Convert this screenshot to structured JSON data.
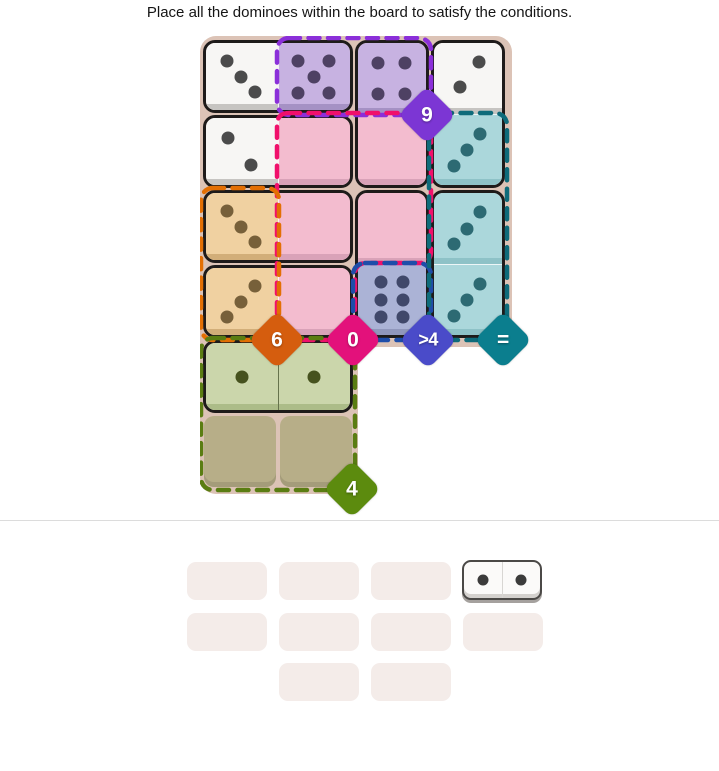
{
  "title": "Place all the dominoes within the board to satisfy the conditions.",
  "board": {
    "frame_color": "#dcc3b6",
    "faces": {
      "white": {
        "bg": "#f7f6f4",
        "pip": "#4b4b4b",
        "lip": "#c6c4c1"
      },
      "purple": {
        "bg": "#c7b2e1",
        "pip": "#4e4163",
        "lip": "#a591c4"
      },
      "pink": {
        "bg": "#f3bccf",
        "pip": "#8a5b72",
        "lip": "#d9a2b8"
      },
      "teal": {
        "bg": "#abd7db",
        "pip": "#2d6a73",
        "lip": "#8ec2c7"
      },
      "orange": {
        "bg": "#f0d1a1",
        "pip": "#77603a",
        "lip": "#d2ae79"
      },
      "blue": {
        "bg": "#abb3d6",
        "pip": "#40486a",
        "lip": "#9097bc"
      },
      "green": {
        "bg": "#cbd6ab",
        "pip": "#46521e",
        "lip": "#acbc88"
      },
      "empty": {
        "bg": "#b7ae88"
      }
    },
    "dominoes": [
      {
        "id": "domino-3-5",
        "cells": [
          [
            0,
            0
          ],
          [
            0,
            1
          ]
        ],
        "divider": "light",
        "halves": [
          {
            "face": "white",
            "pips": 3,
            "pattern": "three_down"
          },
          {
            "face": "purple",
            "pips": 5,
            "pattern": "five"
          }
        ]
      },
      {
        "id": "domino-4-0",
        "cells": [
          [
            0,
            2
          ],
          [
            1,
            2
          ]
        ],
        "divider": "light",
        "halves": [
          {
            "face": "purple",
            "pips": 4,
            "pattern": "four"
          },
          {
            "face": "pink",
            "pips": 0,
            "pattern": "blank"
          }
        ]
      },
      {
        "id": "domino-2-3",
        "cells": [
          [
            0,
            3
          ],
          [
            1,
            3
          ]
        ],
        "divider": "light",
        "halves": [
          {
            "face": "white",
            "pips": 2,
            "pattern": "two_up"
          },
          {
            "face": "teal",
            "pips": 3,
            "pattern": "three_up"
          }
        ]
      },
      {
        "id": "domino-2-0",
        "cells": [
          [
            1,
            0
          ],
          [
            1,
            1
          ]
        ],
        "divider": "light",
        "halves": [
          {
            "face": "white",
            "pips": 2,
            "pattern": "two_down"
          },
          {
            "face": "pink",
            "pips": 0,
            "pattern": "blank"
          }
        ]
      },
      {
        "id": "domino-3-0a",
        "cells": [
          [
            2,
            0
          ],
          [
            2,
            1
          ]
        ],
        "divider": "light",
        "halves": [
          {
            "face": "orange",
            "pips": 3,
            "pattern": "three_down"
          },
          {
            "face": "pink",
            "pips": 0,
            "pattern": "blank"
          }
        ]
      },
      {
        "id": "domino-0-6",
        "cells": [
          [
            2,
            2
          ],
          [
            3,
            2
          ]
        ],
        "divider": "light",
        "halves": [
          {
            "face": "pink",
            "pips": 0,
            "pattern": "blank"
          },
          {
            "face": "blue",
            "pips": 6,
            "pattern": "six"
          }
        ]
      },
      {
        "id": "domino-3-3",
        "cells": [
          [
            2,
            3
          ],
          [
            3,
            3
          ]
        ],
        "divider": "light",
        "halves": [
          {
            "face": "teal",
            "pips": 3,
            "pattern": "three_up"
          },
          {
            "face": "teal",
            "pips": 3,
            "pattern": "three_up"
          }
        ]
      },
      {
        "id": "domino-3-0b",
        "cells": [
          [
            3,
            0
          ],
          [
            3,
            1
          ]
        ],
        "divider": "light",
        "halves": [
          {
            "face": "orange",
            "pips": 3,
            "pattern": "three_up"
          },
          {
            "face": "pink",
            "pips": 0,
            "pattern": "blank"
          }
        ]
      },
      {
        "id": "domino-1-1",
        "cells": [
          [
            4,
            0
          ],
          [
            4,
            1
          ]
        ],
        "divider": "dark",
        "halves": [
          {
            "face": "green",
            "pips": 1,
            "pattern": "one"
          },
          {
            "face": "green",
            "pips": 1,
            "pattern": "one"
          }
        ]
      }
    ],
    "empty_cells": [
      [
        5,
        0
      ],
      [
        5,
        1
      ]
    ],
    "regions": [
      {
        "name": "purple",
        "condition": "9",
        "border_color": "#8b2fd9",
        "badge_color": "#7c36d4"
      },
      {
        "name": "pink",
        "condition": "0",
        "border_color": "#f0106b",
        "badge_color": "#e3117b"
      },
      {
        "name": "orange",
        "condition": "6",
        "border_color": "#e36f03",
        "badge_color": "#d55d0e"
      },
      {
        "name": "blue",
        "condition": ">4",
        "border_color": "#1e4da9",
        "badge_color": "#4a4bc9"
      },
      {
        "name": "teal",
        "condition": "=",
        "border_color": "#0e6b7a",
        "badge_color": "#0b7e8e"
      },
      {
        "name": "green",
        "condition": "4",
        "border_color": "#5a7d12",
        "badge_color": "#5c8b0e"
      }
    ]
  },
  "tray": {
    "slot_color": "#f4ece9",
    "rows": [
      [
        "empty",
        "empty",
        "empty",
        "domino"
      ],
      [
        "empty",
        "empty",
        "empty",
        "empty"
      ],
      [
        null,
        "empty",
        "empty",
        null
      ]
    ],
    "domino": {
      "left_pips": 1,
      "right_pips": 1
    }
  }
}
